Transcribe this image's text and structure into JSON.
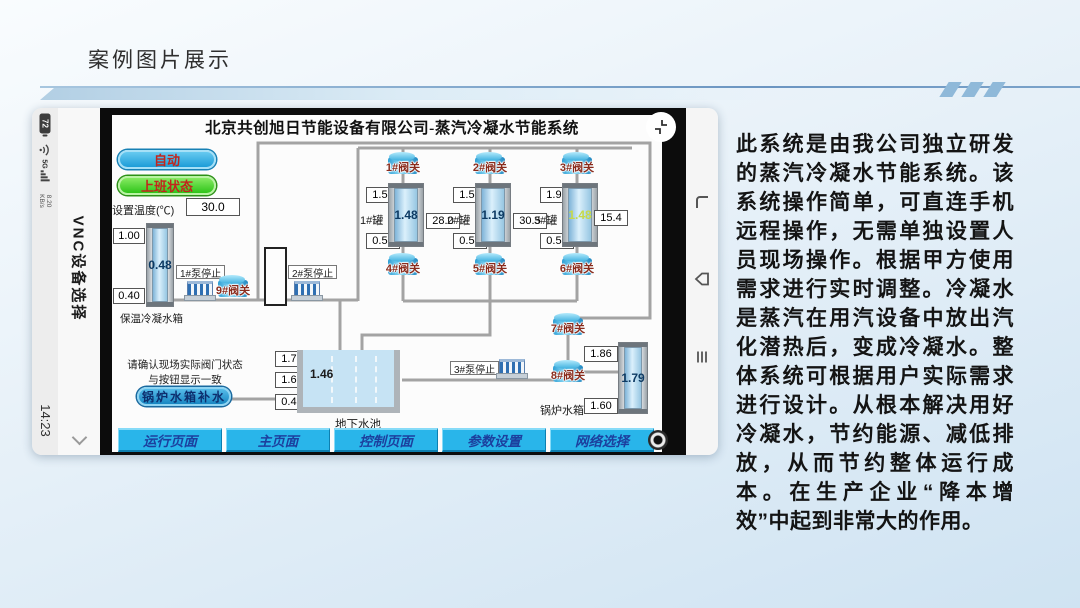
{
  "slide": {
    "title": "案例图片展示",
    "description": "此系统是由我公司独立研发的蒸汽冷凝水节能系统。该系统操作简单，可直连手机远程操作，无需单独设置人员现场操作。根据甲方使用需求进行实时调整。冷凝水是蒸汽在用汽设备中放出汽化潜热后，变成冷凝水。整体系统可根据用户实际需求进行设计。从根本解决用好冷凝水，节约能源、减低排放，从而节约整体运行成本。在生产企业“降本增效”中起到非常大的作用。"
  },
  "phone": {
    "status": {
      "battery": "72",
      "network": "5G",
      "speed_value": "8.20",
      "speed_unit": "KB/s",
      "time": "14:23"
    },
    "app_title": "VNC设备选择"
  },
  "hmi": {
    "title": "北京共创旭日节能设备有限公司-蒸汽冷凝水节能系统",
    "auto_button": "自动",
    "shift_button": "上班状态",
    "set_temp_label": "设置温度(℃)",
    "set_temp_value": "30.0",
    "tanks": [
      {
        "name": "1#罐",
        "top": "1.50",
        "level": "1.48",
        "bottom": "0.50",
        "flow": "28.0",
        "valve_top": "1#阀关",
        "valve_bottom": "4#阀关"
      },
      {
        "name": "2#罐",
        "top": "1.50",
        "level": "1.19",
        "bottom": "0.50",
        "flow": "30.5",
        "valve_top": "2#阀关",
        "valve_bottom": "5#阀关"
      },
      {
        "name": "3#罐",
        "top": "1.95",
        "level": "1.48",
        "bottom": "0.50",
        "flow": "15.4",
        "valve_top": "3#阀关",
        "valve_bottom": "6#阀关",
        "level_color": "#c6d94a"
      }
    ],
    "left_tank": {
      "label": "保温冷凝水箱",
      "top": "1.00",
      "level": "0.48",
      "bottom": "0.40"
    },
    "pool": {
      "label": "地下水池",
      "v1": "1.70",
      "v2": "1.60",
      "v3": "0.45",
      "level": "1.46"
    },
    "boiler_tank": {
      "label": "锅炉水箱",
      "top": "1.86",
      "level": "1.79",
      "bottom": "1.60"
    },
    "pumps": {
      "p1": "1#泵停止",
      "p2": "2#泵停止",
      "p3": "3#泵停止"
    },
    "valves": {
      "v7": "7#阀关",
      "v8": "8#阀关",
      "v9": "9#阀关"
    },
    "notice_line1": "请确认现场实际阀门状态",
    "notice_line2": "与按钮显示一致",
    "makeup_button": "锅炉水箱补水",
    "nav": [
      "运行页面",
      "主页面",
      "控制页面",
      "参数设置",
      "网络选择"
    ],
    "colors": {
      "nav_blue": "#29b5ea",
      "valve_blue": "#2aa6de",
      "shift_green": "#52d62e",
      "button_text_red": "#c2251c"
    }
  }
}
